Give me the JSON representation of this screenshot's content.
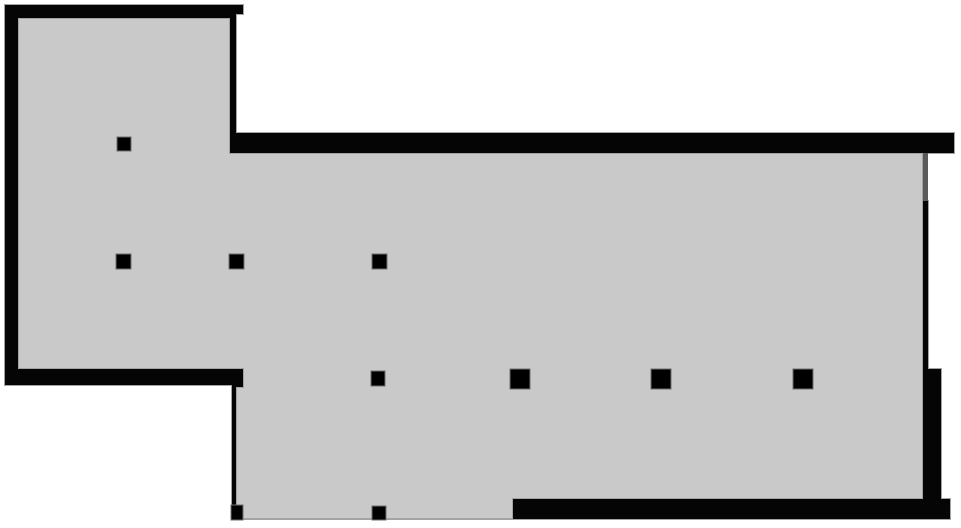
{
  "canvas": {
    "width": 961,
    "height": 528,
    "background": "#ffffff"
  },
  "colors": {
    "floor_fill": "#c9c9c9",
    "outline": "#a3a3a3",
    "wall_fill": "#050505",
    "column_fill": "#000000",
    "column_outline": "#6f6f6f",
    "opening_fill": "#5a5a5a"
  },
  "floor_plan": {
    "floor_polygon": [
      [
        18,
        18
      ],
      [
        230,
        18
      ],
      [
        230,
        153
      ],
      [
        923,
        153
      ],
      [
        923,
        500
      ],
      [
        513,
        500
      ],
      [
        513,
        519
      ],
      [
        236,
        519
      ],
      [
        236,
        385
      ],
      [
        243,
        385
      ],
      [
        243,
        369
      ],
      [
        18,
        369
      ]
    ],
    "walls": [
      {
        "name": "wall-top-left",
        "x": 5,
        "y": 5,
        "w": 228,
        "h": 13
      },
      {
        "name": "wall-top-left-notch",
        "x": 233,
        "y": 5,
        "w": 10,
        "h": 9
      },
      {
        "name": "wall-left",
        "x": 5,
        "y": 5,
        "w": 13,
        "h": 380
      },
      {
        "name": "wall-bottom-left",
        "x": 5,
        "y": 369,
        "w": 228,
        "h": 16
      },
      {
        "name": "wall-bottom-left-step",
        "x": 233,
        "y": 369,
        "w": 10,
        "h": 18
      },
      {
        "name": "wall-room-divider-right",
        "x": 230,
        "y": 14,
        "w": 6,
        "h": 119
      },
      {
        "name": "wall-hall-top",
        "x": 230,
        "y": 133,
        "w": 724,
        "h": 20
      },
      {
        "name": "wall-extension-left-thin",
        "x": 232,
        "y": 385,
        "w": 4,
        "h": 120
      },
      {
        "name": "wall-right-thin",
        "x": 923,
        "y": 201,
        "w": 5,
        "h": 168
      },
      {
        "name": "wall-right-thick",
        "x": 923,
        "y": 369,
        "w": 18,
        "h": 150
      },
      {
        "name": "wall-bottom",
        "x": 513,
        "y": 499,
        "w": 437,
        "h": 20
      }
    ],
    "openings": [
      {
        "name": "opening-right-sliver",
        "x": 923,
        "y": 153,
        "w": 5,
        "h": 48
      }
    ],
    "columns": [
      {
        "name": "column-small",
        "x": 117,
        "y": 137,
        "w": 14,
        "h": 14
      },
      {
        "name": "column-small",
        "x": 116,
        "y": 254,
        "w": 15,
        "h": 15
      },
      {
        "name": "column-small",
        "x": 229,
        "y": 254,
        "w": 15,
        "h": 15
      },
      {
        "name": "column-small",
        "x": 372,
        "y": 254,
        "w": 15,
        "h": 15
      },
      {
        "name": "column-small",
        "x": 371,
        "y": 371,
        "w": 14,
        "h": 15
      },
      {
        "name": "column-large",
        "x": 510,
        "y": 369,
        "w": 20,
        "h": 20
      },
      {
        "name": "column-large",
        "x": 651,
        "y": 369,
        "w": 20,
        "h": 20
      },
      {
        "name": "column-large",
        "x": 793,
        "y": 369,
        "w": 20,
        "h": 20
      },
      {
        "name": "pier",
        "x": 231,
        "y": 505,
        "w": 12,
        "h": 15
      },
      {
        "name": "pier",
        "x": 372,
        "y": 506,
        "w": 14,
        "h": 14
      }
    ]
  }
}
